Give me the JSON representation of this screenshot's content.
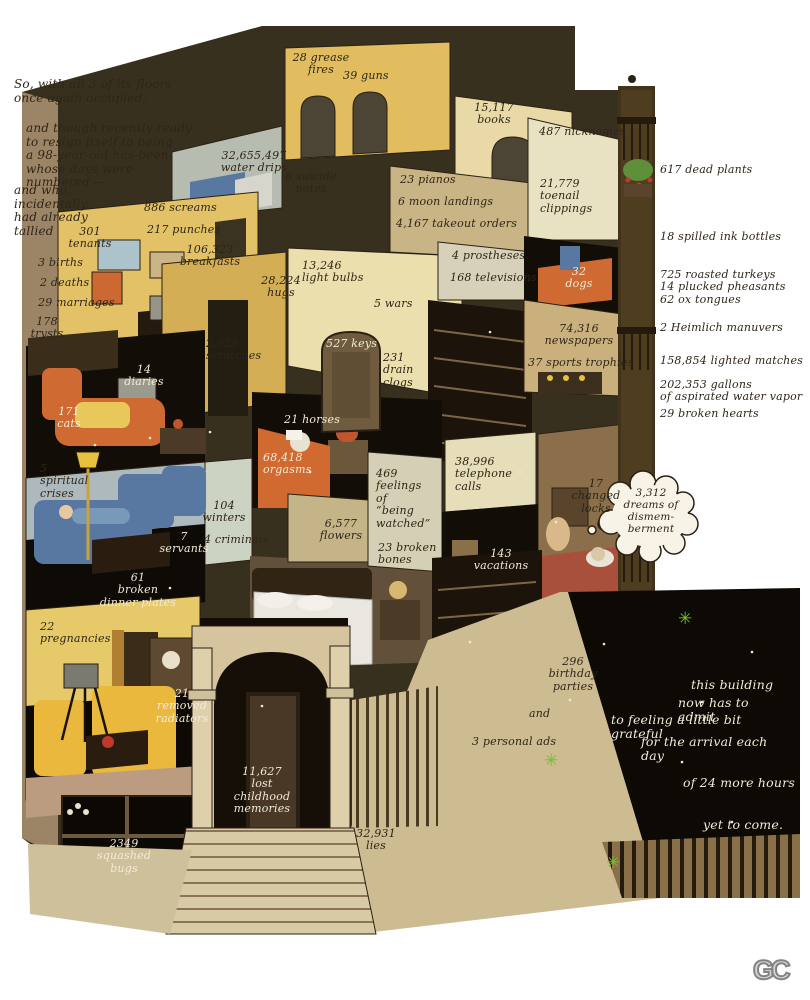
{
  "colors": {
    "ink": "#2e2517",
    "inkWhite": "#f1ebd7",
    "roof": "#38301f",
    "wallYellow": "#e1bd60",
    "wallTan": "#c8b485",
    "wallCream": "#e9d9a6",
    "black": "#120d07",
    "orange": "#cf6a33",
    "blue": "#5878a2",
    "garden": "#0d0905",
    "green": "#72c12d",
    "sidewalk": "#cdbb92",
    "fence": "#8a7049",
    "bubble": "#f7f3e6"
  },
  "logo": "GC",
  "annotations": [
    {
      "key": "intro-1",
      "text": "So, with all 3 of its floors\nonce again occupied,",
      "x": 14,
      "y": 78,
      "w": 200,
      "align": "left",
      "ink": "dark",
      "size": 12
    },
    {
      "key": "intro-2",
      "text": "and though recently ready\nto resign itself to being\na 98-year-old has-been\nwhose days were\nnumbered —",
      "x": 26,
      "y": 122,
      "w": 190,
      "align": "left",
      "ink": "dark",
      "size": 12
    },
    {
      "key": "intro-3",
      "text": "and who,\nincidentally,\nhad already\ntallied",
      "x": 14,
      "y": 184,
      "w": 100,
      "align": "left",
      "ink": "dark",
      "size": 12
    },
    {
      "key": "grease-fires",
      "text": "28 grease\nfires",
      "x": 290,
      "y": 52,
      "w": 62,
      "align": "center",
      "ink": "dark"
    },
    {
      "key": "guns",
      "text": "39 guns",
      "x": 343,
      "y": 70,
      "w": 60,
      "align": "left",
      "ink": "dark"
    },
    {
      "key": "water-drips",
      "text": "32,655,497\nwater drips",
      "x": 218,
      "y": 150,
      "w": 72,
      "align": "center",
      "ink": "dark"
    },
    {
      "key": "suicide-notes",
      "text": "6 suicide\nnotes",
      "x": 283,
      "y": 171,
      "w": 56,
      "align": "center",
      "ink": "dark"
    },
    {
      "key": "books",
      "text": "15,117\nbooks",
      "x": 470,
      "y": 102,
      "w": 48,
      "align": "center",
      "ink": "dark"
    },
    {
      "key": "nicknames",
      "text": "487 nicknames",
      "x": 539,
      "y": 126,
      "w": 95,
      "align": "left",
      "ink": "dark"
    },
    {
      "key": "pianos",
      "text": "23 pianos",
      "x": 400,
      "y": 174,
      "w": 80,
      "align": "left",
      "ink": "dark"
    },
    {
      "key": "moon-landings",
      "text": "6 moon landings",
      "x": 398,
      "y": 196,
      "w": 110,
      "align": "left",
      "ink": "dark"
    },
    {
      "key": "takeout-orders",
      "text": "4,167 takeout orders",
      "x": 396,
      "y": 218,
      "w": 130,
      "align": "left",
      "ink": "dark"
    },
    {
      "key": "toenail-clippings",
      "text": "21,779\ntoenail\nclippings",
      "x": 540,
      "y": 178,
      "w": 58,
      "align": "left",
      "ink": "dark"
    },
    {
      "key": "dead-plants",
      "text": "617 dead plants",
      "x": 660,
      "y": 164,
      "w": 130,
      "align": "left",
      "ink": "dark"
    },
    {
      "key": "screams",
      "text": "886 screams",
      "x": 144,
      "y": 202,
      "w": 90,
      "align": "left",
      "ink": "dark"
    },
    {
      "key": "punches",
      "text": "217 punches",
      "x": 147,
      "y": 224,
      "w": 90,
      "align": "left",
      "ink": "dark"
    },
    {
      "key": "breakfasts",
      "text": "106,323\nbreakfasts",
      "x": 178,
      "y": 244,
      "w": 64,
      "align": "center",
      "ink": "dark"
    },
    {
      "key": "tenants",
      "text": "301\ntenants",
      "x": 66,
      "y": 226,
      "w": 48,
      "align": "center",
      "ink": "dark"
    },
    {
      "key": "births",
      "text": "3 births",
      "x": 38,
      "y": 257,
      "w": 60,
      "align": "left",
      "ink": "dark"
    },
    {
      "key": "deaths",
      "text": "2 deaths",
      "x": 40,
      "y": 277,
      "w": 60,
      "align": "left",
      "ink": "dark"
    },
    {
      "key": "marriages",
      "text": "29 marriages",
      "x": 38,
      "y": 297,
      "w": 90,
      "align": "left",
      "ink": "dark"
    },
    {
      "key": "trysts",
      "text": "178\ntrysts",
      "x": 26,
      "y": 316,
      "w": 42,
      "align": "center",
      "ink": "dark"
    },
    {
      "key": "spilled-ink-bottles",
      "text": "18 spilled ink bottles",
      "x": 660,
      "y": 231,
      "w": 140,
      "align": "left",
      "ink": "dark"
    },
    {
      "key": "light-bulbs",
      "text": "13,246\nlight bulbs",
      "x": 302,
      "y": 260,
      "w": 70,
      "align": "left",
      "ink": "dark"
    },
    {
      "key": "hugs",
      "text": "28,224\nhugs",
      "x": 253,
      "y": 275,
      "w": 56,
      "align": "center",
      "ink": "dark"
    },
    {
      "key": "wars",
      "text": "5 wars",
      "x": 374,
      "y": 298,
      "w": 50,
      "align": "left",
      "ink": "dark"
    },
    {
      "key": "roasted-turkeys",
      "text": "725 roasted turkeys\n14 plucked pheasants\n62 ox tongues",
      "x": 660,
      "y": 269,
      "w": 145,
      "align": "left",
      "ink": "dark"
    },
    {
      "key": "prostheses",
      "text": "4 prostheses",
      "x": 452,
      "y": 250,
      "w": 90,
      "align": "left",
      "ink": "dark"
    },
    {
      "key": "televisions",
      "text": "168 televisions",
      "x": 450,
      "y": 272,
      "w": 100,
      "align": "left",
      "ink": "dark"
    },
    {
      "key": "dogs",
      "text": "32\ndogs",
      "x": 562,
      "y": 266,
      "w": 34,
      "align": "center",
      "ink": "white"
    },
    {
      "key": "scratches",
      "text": "2,325\nscratches",
      "x": 206,
      "y": 338,
      "w": 62,
      "align": "left",
      "ink": "dark"
    },
    {
      "key": "keys",
      "text": "527 keys",
      "x": 326,
      "y": 338,
      "w": 60,
      "align": "left",
      "ink": "white"
    },
    {
      "key": "drain-clogs",
      "text": "231\ndrain\nclogs",
      "x": 383,
      "y": 352,
      "w": 40,
      "align": "left",
      "ink": "dark"
    },
    {
      "key": "heimlich-manuvers",
      "text": "2 Heimlich manuvers",
      "x": 660,
      "y": 322,
      "w": 150,
      "align": "left",
      "ink": "dark"
    },
    {
      "key": "newspapers",
      "text": "74,316\nnewspapers",
      "x": 543,
      "y": 323,
      "w": 72,
      "align": "center",
      "ink": "dark"
    },
    {
      "key": "sports-trophies",
      "text": "37 sports trophies",
      "x": 528,
      "y": 357,
      "w": 120,
      "align": "left",
      "ink": "dark"
    },
    {
      "key": "lighted-matches",
      "text": "158,854 lighted matches",
      "x": 660,
      "y": 355,
      "w": 150,
      "align": "left",
      "ink": "dark"
    },
    {
      "key": "water-vapor",
      "text": "202,353 gallons\nof aspirated water vapor",
      "x": 660,
      "y": 379,
      "w": 150,
      "align": "left",
      "ink": "dark"
    },
    {
      "key": "diaries",
      "text": "14\ndiaries",
      "x": 120,
      "y": 364,
      "w": 48,
      "align": "center",
      "ink": "white"
    },
    {
      "key": "broken-hearts",
      "text": "29 broken hearts",
      "x": 660,
      "y": 408,
      "w": 130,
      "align": "left",
      "ink": "dark"
    },
    {
      "key": "cats",
      "text": "171\ncats",
      "x": 48,
      "y": 406,
      "w": 42,
      "align": "center",
      "ink": "white"
    },
    {
      "key": "horses",
      "text": "21 horses",
      "x": 284,
      "y": 414,
      "w": 66,
      "align": "left",
      "ink": "white"
    },
    {
      "key": "orgasms",
      "text": "68,418\norgasms",
      "x": 263,
      "y": 452,
      "w": 58,
      "align": "left",
      "ink": "white"
    },
    {
      "key": "telephone-calls",
      "text": "38,996\ntelephone calls",
      "x": 455,
      "y": 456,
      "w": 85,
      "align": "left",
      "ink": "dark"
    },
    {
      "key": "spiritual-crises",
      "text": "5\nspiritual\ncrises",
      "x": 40,
      "y": 463,
      "w": 60,
      "align": "left",
      "ink": "dark"
    },
    {
      "key": "changed-locks",
      "text": "17\nchanged\nlocks",
      "x": 568,
      "y": 478,
      "w": 56,
      "align": "center",
      "ink": "dark"
    },
    {
      "key": "dreams-of-dismemberment",
      "text": "3,312\ndreams of\ndismem-\nberment",
      "x": 620,
      "y": 488,
      "w": 62,
      "align": "center",
      "ink": "dark",
      "size": 10.5
    },
    {
      "key": "feelings-watched",
      "text": "469\nfeelings of\n“being\nwatched”",
      "x": 376,
      "y": 468,
      "w": 58,
      "align": "left",
      "ink": "dark"
    },
    {
      "key": "winters",
      "text": "104\nwinters",
      "x": 198,
      "y": 500,
      "w": 52,
      "align": "center",
      "ink": "dark"
    },
    {
      "key": "criminals",
      "text": "4 criminals",
      "x": 204,
      "y": 534,
      "w": 75,
      "align": "left",
      "ink": "dark"
    },
    {
      "key": "servants",
      "text": "7\nservants",
      "x": 156,
      "y": 531,
      "w": 56,
      "align": "center",
      "ink": "white"
    },
    {
      "key": "flowers",
      "text": "6,577\nflowers",
      "x": 313,
      "y": 518,
      "w": 56,
      "align": "center",
      "ink": "dark"
    },
    {
      "key": "vacations",
      "text": "143\nvacations",
      "x": 470,
      "y": 548,
      "w": 62,
      "align": "center",
      "ink": "white"
    },
    {
      "key": "broken-bones",
      "text": "23 broken\nbones",
      "x": 378,
      "y": 542,
      "w": 66,
      "align": "left",
      "ink": "dark"
    },
    {
      "key": "broken-dinner-plates",
      "text": "61\nbroken\ndinner plates",
      "x": 96,
      "y": 572,
      "w": 84,
      "align": "center",
      "ink": "white"
    },
    {
      "key": "pregnancies",
      "text": "22\npregnancies",
      "x": 40,
      "y": 621,
      "w": 90,
      "align": "left",
      "ink": "dark"
    },
    {
      "key": "birthday-parties",
      "text": "296\nbirthday\nparties",
      "x": 548,
      "y": 656,
      "w": 50,
      "align": "center",
      "ink": "dark"
    },
    {
      "key": "removed-radiators",
      "text": "21\nremoved\nradiators",
      "x": 148,
      "y": 688,
      "w": 68,
      "align": "center",
      "ink": "white"
    },
    {
      "key": "and",
      "text": "and",
      "x": 529,
      "y": 708,
      "w": 40,
      "align": "left",
      "ink": "dark"
    },
    {
      "key": "personal-ads",
      "text": "3 personal ads",
      "x": 472,
      "y": 736,
      "w": 100,
      "align": "left",
      "ink": "dark"
    },
    {
      "key": "grateful-1",
      "text": "this building",
      "x": 691,
      "y": 678,
      "w": 90,
      "align": "left",
      "ink": "white",
      "size": 12.5
    },
    {
      "key": "grateful-2",
      "text": "now has to admit",
      "x": 678,
      "y": 696,
      "w": 110,
      "align": "left",
      "ink": "white",
      "size": 12.5
    },
    {
      "key": "grateful-3",
      "text": "to feeling a little bit grateful",
      "x": 611,
      "y": 713,
      "w": 180,
      "align": "left",
      "ink": "white",
      "size": 12.5
    },
    {
      "key": "grateful-4",
      "text": "for the arrival each day",
      "x": 641,
      "y": 735,
      "w": 150,
      "align": "left",
      "ink": "white",
      "size": 12.5
    },
    {
      "key": "grateful-5",
      "text": "of 24 more hours",
      "x": 683,
      "y": 776,
      "w": 120,
      "align": "left",
      "ink": "white",
      "size": 12.5
    },
    {
      "key": "grateful-6",
      "text": "yet to come.",
      "x": 703,
      "y": 818,
      "w": 100,
      "align": "left",
      "ink": "white",
      "size": 12.5
    },
    {
      "key": "lost-childhood-memories",
      "text": "11,627\nlost childhood\nmemories",
      "x": 222,
      "y": 766,
      "w": 80,
      "align": "center",
      "ink": "white"
    },
    {
      "key": "lies",
      "text": "32,931\nlies",
      "x": 350,
      "y": 828,
      "w": 52,
      "align": "center",
      "ink": "dark"
    },
    {
      "key": "squashed-bugs",
      "text": "2349\nsquashed\nbugs",
      "x": 90,
      "y": 838,
      "w": 68,
      "align": "center",
      "ink": "white"
    }
  ]
}
